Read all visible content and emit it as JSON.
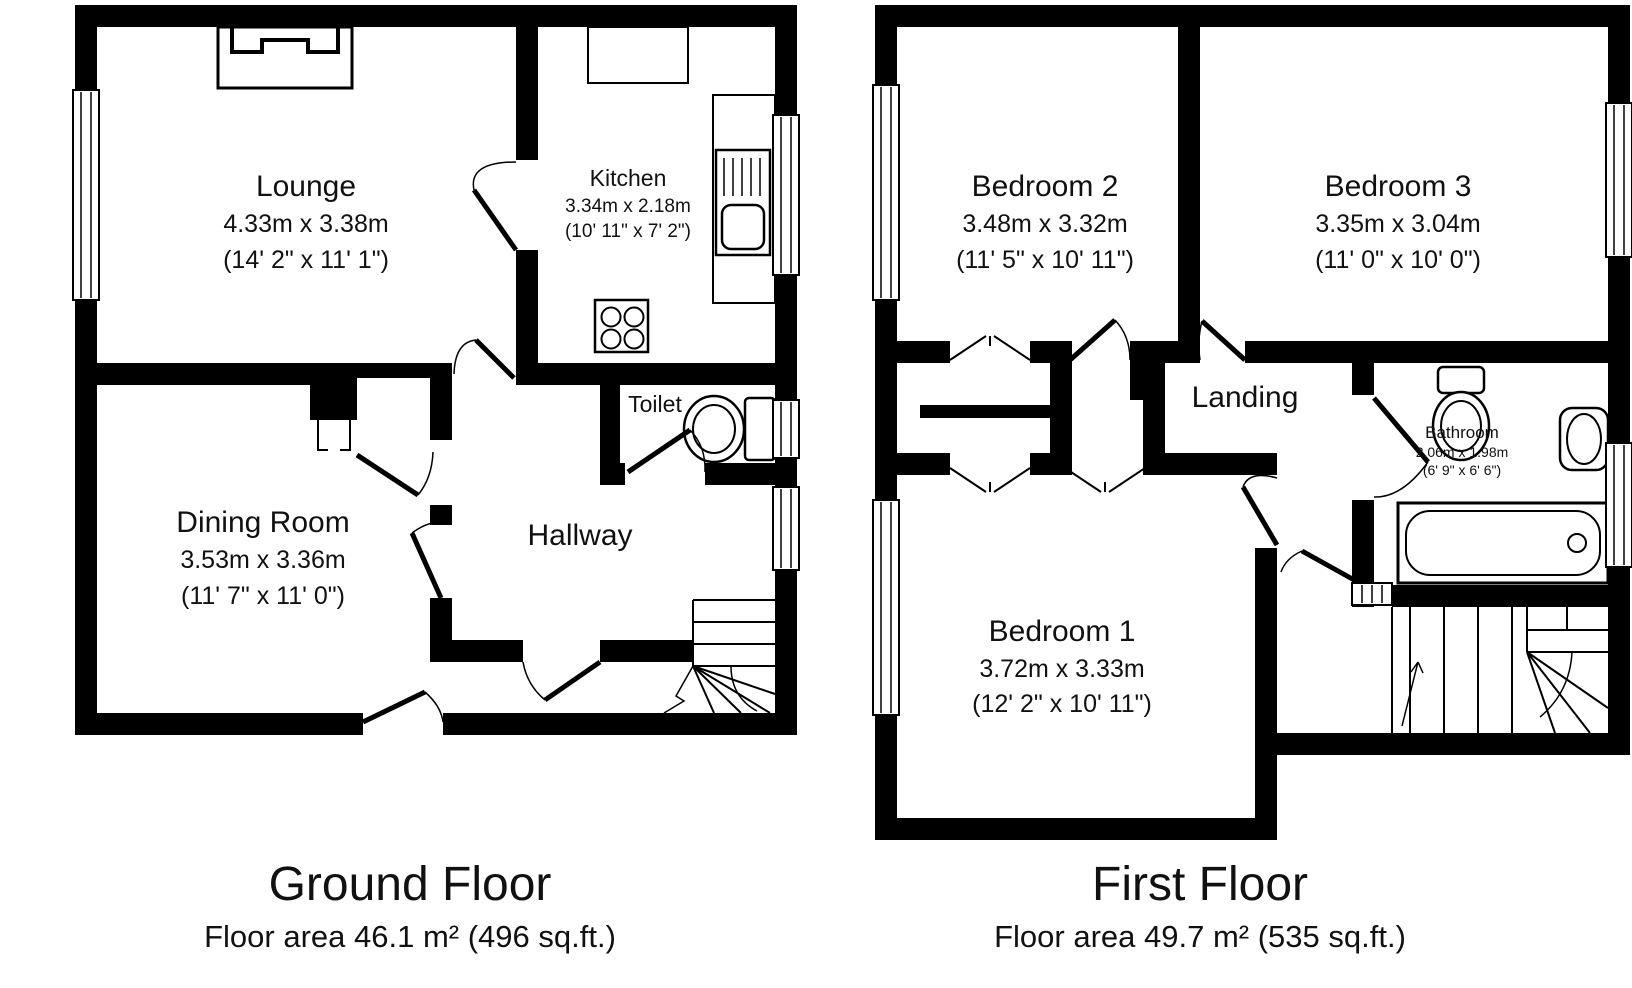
{
  "document_title": "Floor plan",
  "colors": {
    "wall": "#000000",
    "floor": "#ffffff",
    "background": "#ffffff",
    "text": "#111111"
  },
  "floors": [
    {
      "title": "Ground Floor",
      "area_label": "Floor area 46.1 m² (496 sq.ft.)",
      "rooms": [
        {
          "name": "Lounge",
          "dims_m": "4.33m x 3.38m",
          "dims_ft": "(14' 2\" x 11' 1\")"
        },
        {
          "name": "Kitchen",
          "dims_m": "3.34m x 2.18m",
          "dims_ft": "(10' 11\" x 7' 2\")"
        },
        {
          "name": "Toilet",
          "dims_m": "",
          "dims_ft": ""
        },
        {
          "name": "Dining Room",
          "dims_m": "3.53m x 3.36m",
          "dims_ft": "(11' 7\" x 11' 0\")"
        },
        {
          "name": "Hallway",
          "dims_m": "",
          "dims_ft": ""
        }
      ]
    },
    {
      "title": "First Floor",
      "area_label": "Floor area 49.7 m² (535 sq.ft.)",
      "rooms": [
        {
          "name": "Bedroom 2",
          "dims_m": "3.48m x 3.32m",
          "dims_ft": "(11' 5\" x 10' 11\")"
        },
        {
          "name": "Bedroom 3",
          "dims_m": "3.35m x 3.04m",
          "dims_ft": "(11' 0\" x 10' 0\")"
        },
        {
          "name": "Landing",
          "dims_m": "",
          "dims_ft": ""
        },
        {
          "name": "Bathroom",
          "dims_m": "2.06m x 1.98m",
          "dims_ft": "(6' 9\" x 6' 6\")"
        },
        {
          "name": "Bedroom 1",
          "dims_m": "3.72m x 3.33m",
          "dims_ft": "(12' 2\" x 10' 11\")"
        }
      ]
    }
  ]
}
